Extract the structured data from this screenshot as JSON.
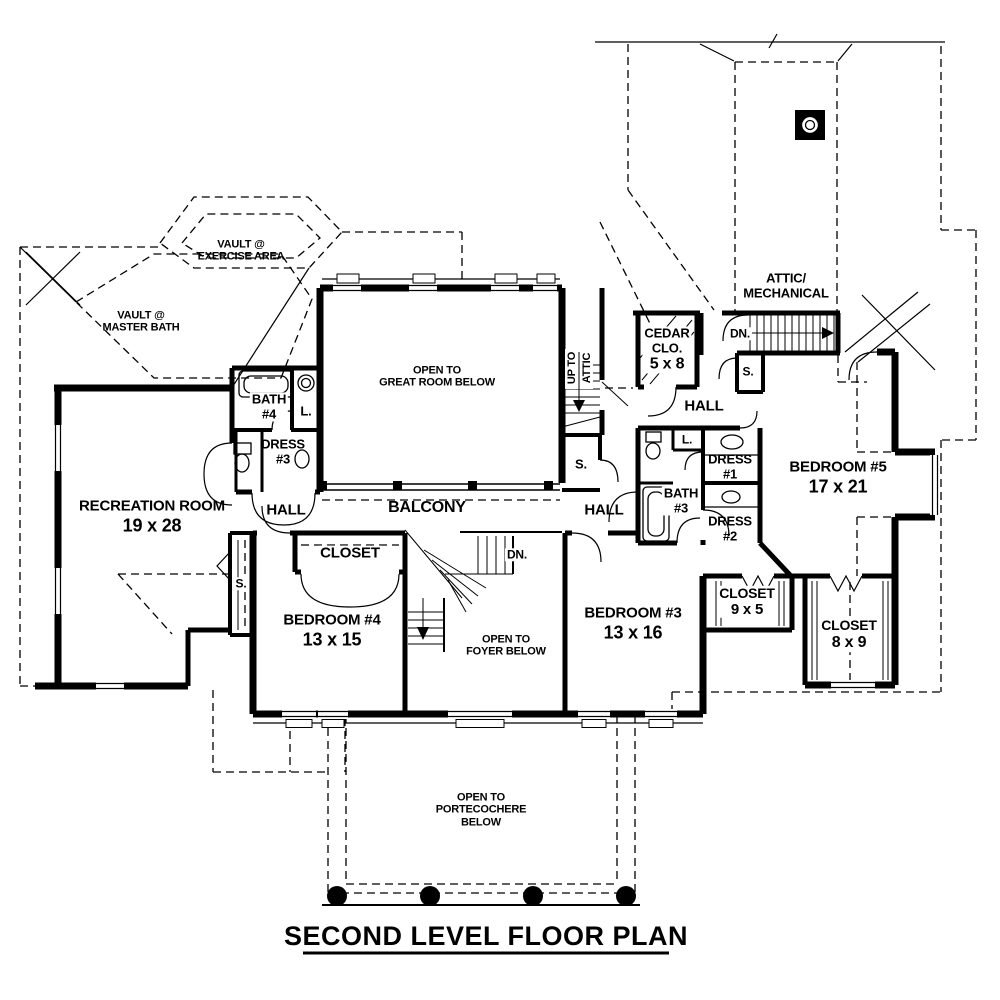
{
  "title": "SECOND LEVEL FLOOR PLAN",
  "labels": {
    "vault_exercise": {
      "line1": "VAULT @",
      "line2": "EXERCISE AREA"
    },
    "vault_master_bath": {
      "line1": "VAULT @",
      "line2": "MASTER BATH"
    },
    "open_to_great_room": {
      "line1": "OPEN TO",
      "line2": "GREAT ROOM BELOW"
    },
    "attic_mechanical": {
      "line1": "ATTIC/",
      "line2": "MECHANICAL"
    },
    "cedar_closet": {
      "line1": "CEDAR",
      "line2": "CLO.",
      "dims": "5 x 8"
    },
    "up_to_attic": {
      "line1": "UP TO",
      "line2": "ATTIC"
    },
    "dn_attic": "DN.",
    "dn_foyer": "DN.",
    "hall_upper_right": "HALL",
    "hall_left": "HALL",
    "hall_center": "HALL",
    "bath_4": {
      "line1": "BATH",
      "line2": "#4"
    },
    "bath_3": {
      "line1": "BATH",
      "line2": "#3"
    },
    "linen_bath4": "L.",
    "linen_bath3": "L.",
    "dress_1": {
      "line1": "DRESS",
      "line2": "#1"
    },
    "dress_2": {
      "line1": "DRESS",
      "line2": "#2"
    },
    "dress_3": {
      "line1": "DRESS",
      "line2": "#3"
    },
    "storage_stair": "S.",
    "storage_attic": "S.",
    "storage_rec": "S.",
    "recreation_room": {
      "name": "RECREATION ROOM",
      "dims": "19 x 28"
    },
    "balcony": "BALCONY",
    "bedroom_5": {
      "name": "BEDROOM #5",
      "dims": "17 x 21"
    },
    "bedroom_4": {
      "name": "BEDROOM #4",
      "dims": "13 x 15"
    },
    "bedroom_3": {
      "name": "BEDROOM #3",
      "dims": "13 x 16"
    },
    "closet_bedroom4": "CLOSET",
    "closet_9x5": {
      "name": "CLOSET",
      "dims": "9 x 5"
    },
    "closet_8x9": {
      "name": "CLOSET",
      "dims": "8 x 9"
    },
    "open_to_foyer": {
      "line1": "OPEN TO",
      "line2": "FOYER BELOW"
    },
    "open_to_portecochere": {
      "line1": "OPEN TO",
      "line2": "PORTECOCHERE",
      "line3": "BELOW"
    }
  },
  "colors": {
    "ink": "#000000",
    "paper": "#ffffff"
  }
}
